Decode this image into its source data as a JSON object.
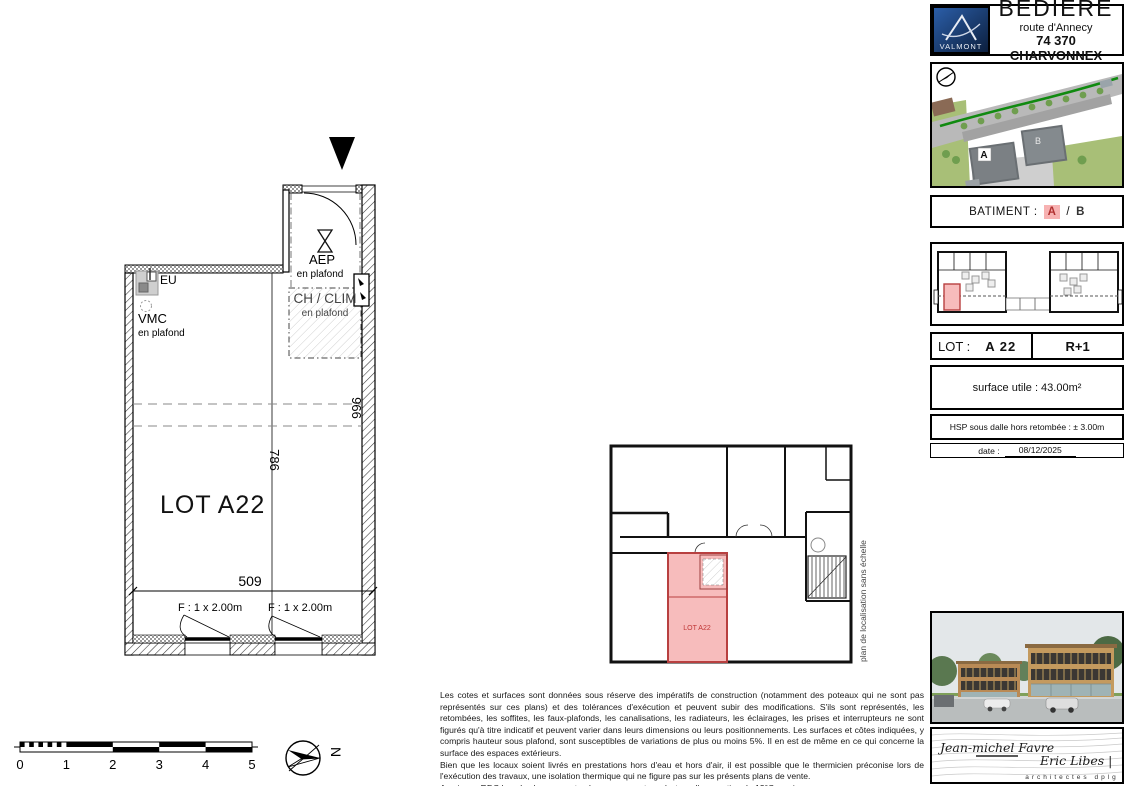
{
  "title_block": {
    "logo": "VALMONT",
    "project": "BEDIERE",
    "address1": "route d'Annecy",
    "address2": "74 370 CHARVONNEX"
  },
  "batiment": {
    "label": "BATIMENT :",
    "building_a": "A",
    "separator": "/",
    "building_b": "B"
  },
  "lot_row": {
    "label": "LOT :",
    "lot": "A 22",
    "level": "R+1"
  },
  "surface_row": {
    "text": "surface utile : 43.00m²"
  },
  "hsp_row": {
    "text": "HSP sous dalle hors retombée : ± 3.00m"
  },
  "date_row": {
    "label": "date :",
    "value": "08/12/2025"
  },
  "site_plan": {
    "building_a_label": "A",
    "building_b_label": "B"
  },
  "main_plan": {
    "lot_label": "LOT A22",
    "labels": {
      "eu": "EU",
      "vmc": "VMC",
      "vmc_sub": "en plafond",
      "aep": "AEP",
      "aep_sub": "en plafond",
      "ch_clim": "CH / CLIM",
      "ch_clim_sub": "en plafond"
    },
    "dimensions": {
      "width": "509",
      "height_left": "786",
      "height_right": "966"
    },
    "windows": {
      "w1": "F : 1 x 2.00m",
      "w2": "F : 1 x 2.00m"
    }
  },
  "location_plan": {
    "lot_label": "LOT A22",
    "caption": "plan de localisation sans échelle"
  },
  "scale_bar": {
    "ticks": [
      "0",
      "1",
      "2",
      "3",
      "4",
      "5"
    ]
  },
  "north_arrow": {
    "label": "N"
  },
  "notes": {
    "p1": "Les cotes et surfaces sont données sous réserve des impératifs de construction (notamment des poteaux qui ne sont pas représentés sur ces plans) et des tolérances d'exécution et peuvent subir des modifications. S'ils sont représentés, les retombées, les soffites, les faux-plafonds, les canalisations, les radiateurs, les éclairages, les prises et interrupteurs ne sont figurés qu'à titre indicatif et peuvent varier dans leurs dimensions ou leurs positionnements. Les surfaces et côtes indiquées, y compris hauteur sous plafond, sont susceptibles de variations de plus ou moins 5%. Il en est de même en ce qui concerne la surface des espaces extérieurs.",
    "p2": "Bien que les locaux soient livrés en prestations hors d'eau et hors d'air, il est possible que le thermicien préconise lors de l'exécution des travaux, une isolation thermique qui ne figure pas sur les présents plans de vente.",
    "p3": "Au niveau RDC bas, les locaux sont prévus pour une température d'occupation de 12°C maximum."
  },
  "architects": {
    "architect1": "Jean-michel Favre",
    "architect2": "Eric Libes |",
    "title": "architectes dplg"
  }
}
